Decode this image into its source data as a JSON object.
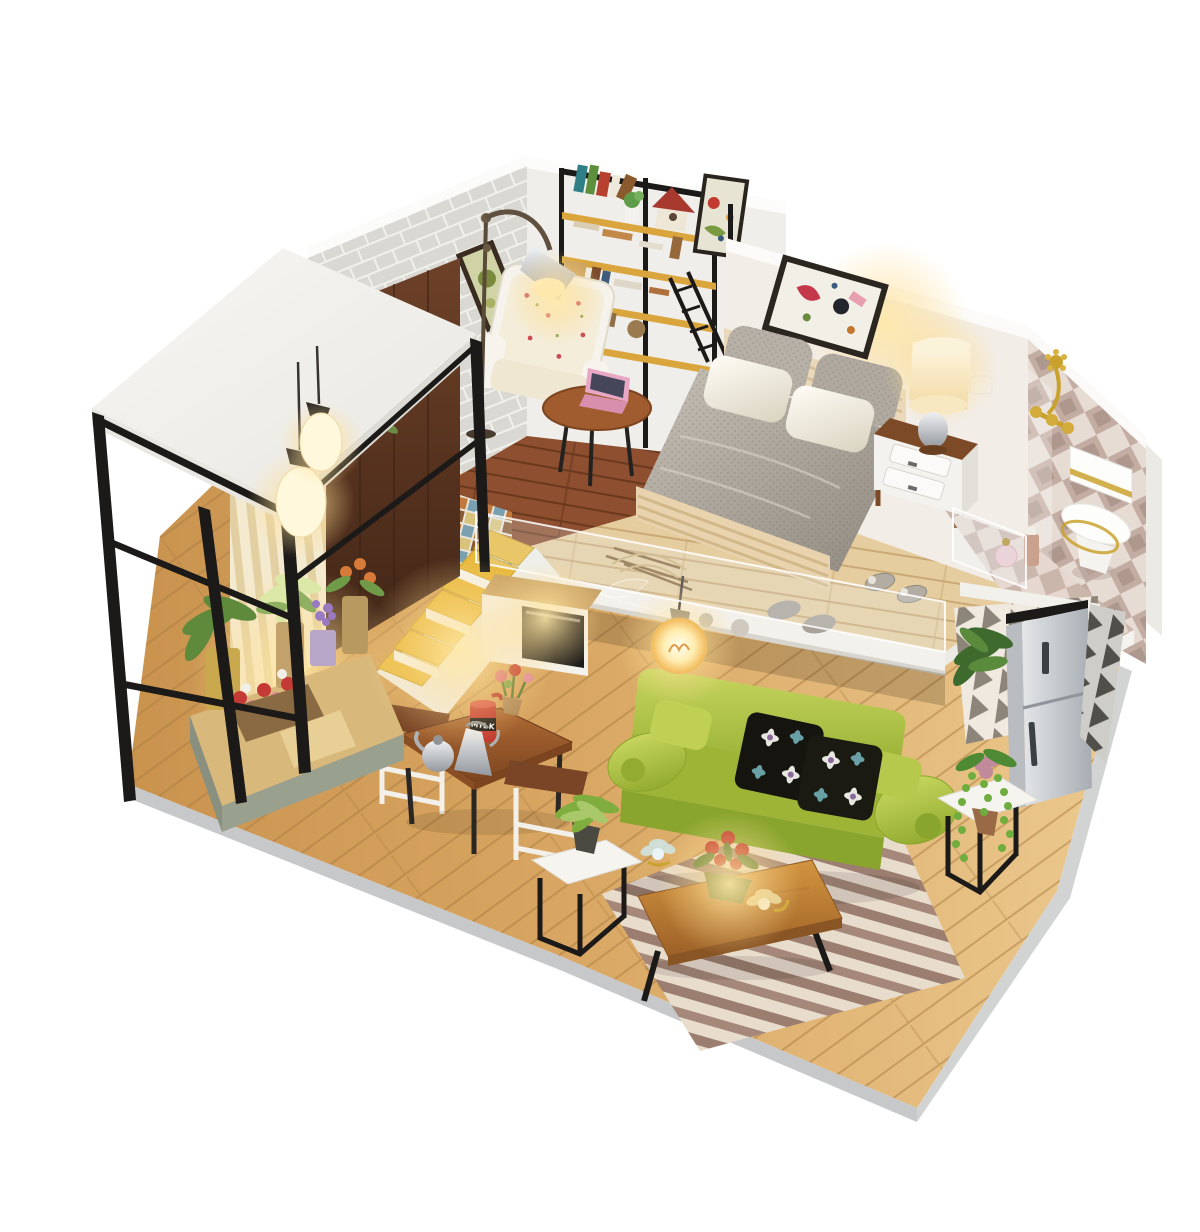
{
  "meta": {
    "type": "product-photo",
    "subject": "DIY miniature dollhouse kit — modern two-level loft apartment model",
    "background": "#ffffff"
  },
  "labels": {
    "milk_can": "MILK"
  },
  "palette": {
    "sofa_green": "#a9bf3f",
    "stair_tread_yellow": "#e8b93e",
    "shelf_wood_yellow": "#d9a53c",
    "floor_oak": "#d7a464",
    "deck_wood": "#e6cda0",
    "study_floor_wood": "#8d4f2f",
    "walnut_door": "#5a3420",
    "brick_gray": "#d9d8d2",
    "bath_tile_mauve": "#c3aca2",
    "rug_mauve": "#9b7e70",
    "rug_cream": "#e8dccd",
    "steel_black": "#1c1a18",
    "warm_light": "#ffe9a8",
    "base_edge_gray": "#c6c8c9",
    "fridge_silver": "#c3c8cd",
    "milk_can_red": "#c33a30"
  },
  "scene": {
    "areas": [
      {
        "name": "entry-balcony",
        "objects": [
          "white flat roof",
          "black steel frame",
          "glass pendant lamps",
          "striped curtains",
          "walnut door with flower decal",
          "potted plants",
          "flower box",
          "glowing wood platform"
        ]
      },
      {
        "name": "reading-nook",
        "objects": [
          "whitewashed brick wall",
          "steel and wood bookshelf",
          "books",
          "red-roof birdhouse",
          "potted plant",
          "wall posters",
          "chrome floor lamp",
          "floral armchair",
          "round side table",
          "pink laptop"
        ]
      },
      {
        "name": "loft-bedroom",
        "objects": [
          "double bed",
          "gray knit blanket",
          "knit pillows",
          "white satin pillows",
          "slat headboard",
          "abstract wall art",
          "nightstand",
          "lit table lamp",
          "acrylic railing",
          "knit slippers"
        ]
      },
      {
        "name": "bathroom",
        "objects": [
          "diamond tile wall",
          "gold faucet",
          "white and gold toilet",
          "perfume bottles",
          "tile floor"
        ]
      },
      {
        "name": "kitchenette",
        "objects": [
          "white counter",
          "built-in black oven",
          "silver refrigerator",
          "triangle pattern wallpaper"
        ]
      },
      {
        "name": "dining-area",
        "objects": [
          "wood dining table",
          "two white frame chairs",
          "red milk can",
          "silver kettles",
          "flower vase"
        ]
      },
      {
        "name": "living-room",
        "objects": [
          "green fabric sofa",
          "black floral pillows",
          "striped rug",
          "live-edge bench coffee table",
          "glass lotus ornaments",
          "red flower bowl",
          "cube side tables",
          "hanging edison bulb",
          "house plants"
        ]
      },
      {
        "name": "stairs",
        "objects": [
          "yellow stair treads",
          "white stringer",
          "mosaic tile wall"
        ]
      }
    ]
  }
}
